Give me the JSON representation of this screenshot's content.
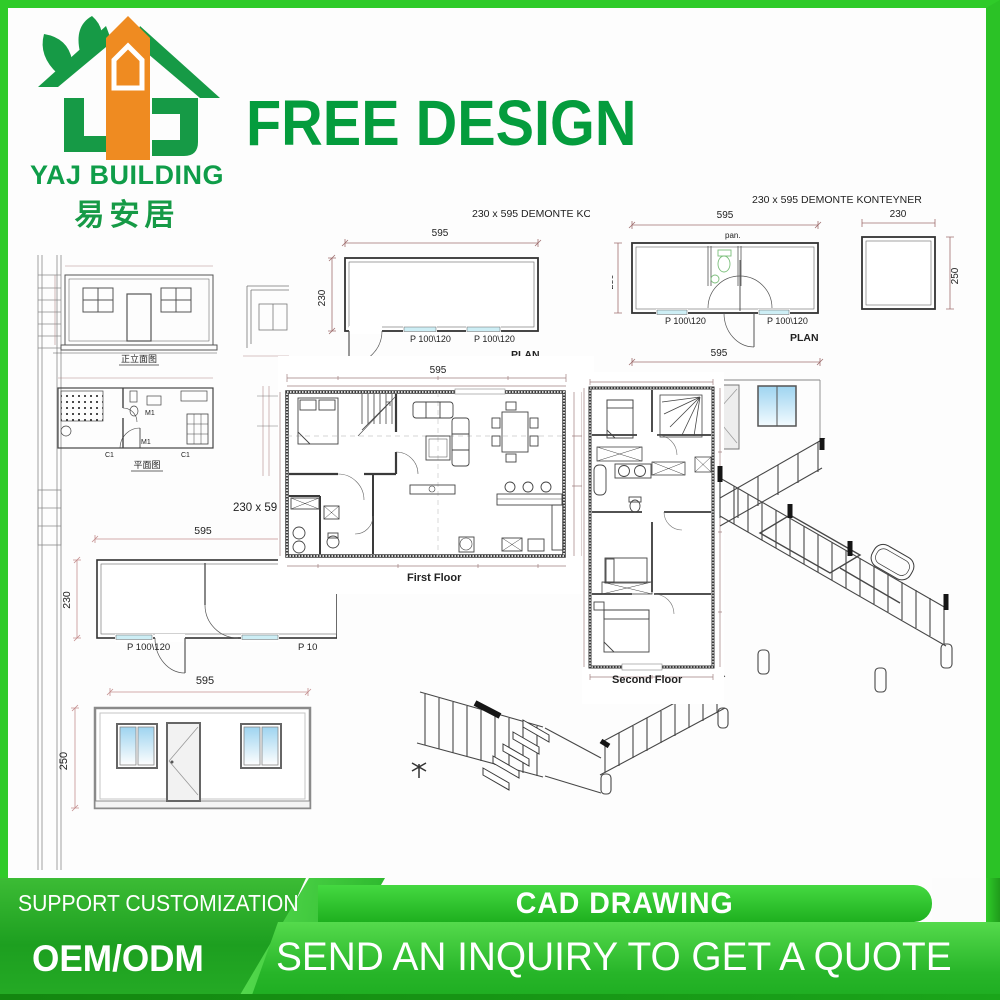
{
  "brand": {
    "name": "YAJ BUILDING",
    "chinese": "易安居"
  },
  "headline": "FREE DESIGN",
  "sheet_left": {
    "elevation_label": "正立面图",
    "plan_label": "平面图",
    "c1a": "C1",
    "c1b": "C1",
    "m1a": "M1",
    "m1b": "M1"
  },
  "plan_top_mid": {
    "title": "230 x 595 DEMONTE KONT",
    "width": "595",
    "height": "230",
    "door1": "P 100\\120",
    "door2": "P 100\\120",
    "plan": "PLAN"
  },
  "plan_top_right": {
    "title": "230 x 595 DEMONTE KONTEYNER",
    "width": "595",
    "height": "230",
    "pan": "pan.",
    "door1": "P 100\\120",
    "door2": "P 100\\120",
    "plan": "PLAN",
    "side_width": "230",
    "side_height": "250",
    "bottom_width": "595"
  },
  "first_floor": {
    "width": "595",
    "side_note": "230 x 59",
    "label": "First Floor"
  },
  "second_floor": {
    "label": "Second Floor"
  },
  "plan_bottom_left": {
    "width": "595",
    "height": "230",
    "door1": "P 100\\120",
    "door2": "P 10"
  },
  "elevation_bottom_left": {
    "width": "595",
    "height": "250"
  },
  "banner": {
    "support": "SUPPORT CUSTOMIZATION",
    "oem": "OEM/ODM",
    "cad": "CAD DRAWING",
    "inquiry": "SEND AN INQUIRY TO GET A QUOTE"
  },
  "colors": {
    "frame_green": "#2fcb29",
    "brand_green": "#0f9d49",
    "logo_orange": "#ef8b21",
    "headline_green": "#049c3d",
    "banner_dark_green": "#1d9f20",
    "banner_bright_green": "#45d941",
    "window_cyan": "#cdeef5",
    "window_blue": "#9ed4f0"
  }
}
